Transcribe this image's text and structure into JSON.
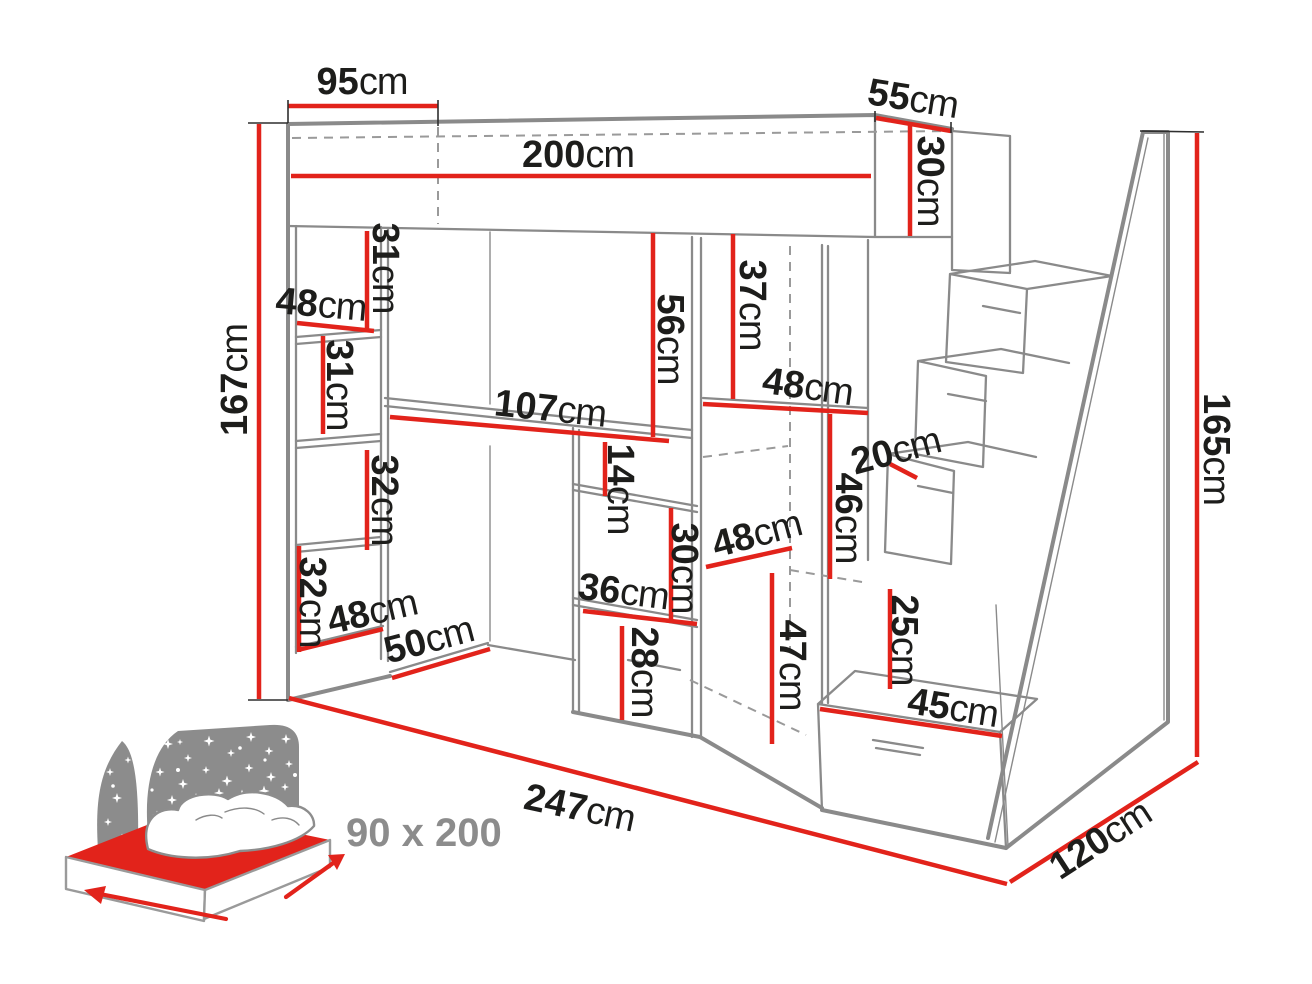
{
  "diagram": {
    "type": "furniture-dimension-drawing",
    "subject": "loft bed with desk, shelves and stair drawers",
    "colors": {
      "dimension_red": "#e2231b",
      "outline_gray": "#8a8a8a",
      "label_black": "#1d1d1b",
      "icon_gray": "#8c8c8c"
    },
    "footprint_icon": {
      "label": "90 x 200",
      "meaning": "mattress size icon"
    },
    "labels": [
      {
        "id": "95",
        "value": "95",
        "unit": "cm",
        "x": 362,
        "y": 94,
        "rot": 0
      },
      {
        "id": "200",
        "value": "200",
        "unit": "cm",
        "x": 578,
        "y": 167,
        "rot": 0
      },
      {
        "id": "55",
        "value": "55",
        "unit": "cm",
        "x": 911,
        "y": 111,
        "rot": 9
      },
      {
        "id": "30-bed",
        "value": "30",
        "unit": "cm",
        "x": 918,
        "y": 181,
        "rot": 90
      },
      {
        "id": "31-upper",
        "value": "31",
        "unit": "cm",
        "x": 373,
        "y": 268,
        "rot": 90
      },
      {
        "id": "48-shelf-top",
        "value": "48",
        "unit": "cm",
        "x": 320,
        "y": 317,
        "rot": 5
      },
      {
        "id": "31-lower",
        "value": "31",
        "unit": "cm",
        "x": 327,
        "y": 385,
        "rot": 90
      },
      {
        "id": "167",
        "value": "167",
        "unit": "cm",
        "x": 247,
        "y": 380,
        "rot": -90
      },
      {
        "id": "56",
        "value": "56",
        "unit": "cm",
        "x": 658,
        "y": 339,
        "rot": 90
      },
      {
        "id": "37",
        "value": "37",
        "unit": "cm",
        "x": 740,
        "y": 305,
        "rot": 90
      },
      {
        "id": "107",
        "value": "107",
        "unit": "cm",
        "x": 549,
        "y": 421,
        "rot": 6
      },
      {
        "id": "48-wardrobe-top",
        "value": "48",
        "unit": "cm",
        "x": 806,
        "y": 399,
        "rot": 8
      },
      {
        "id": "20",
        "value": "20",
        "unit": "cm",
        "x": 899,
        "y": 463,
        "rot": -15
      },
      {
        "id": "14",
        "value": "14",
        "unit": "cm",
        "x": 608,
        "y": 489,
        "rot": 90
      },
      {
        "id": "46",
        "value": "46",
        "unit": "cm",
        "x": 836,
        "y": 518,
        "rot": 90
      },
      {
        "id": "32-upper",
        "value": "32",
        "unit": "cm",
        "x": 372,
        "y": 500,
        "rot": 90
      },
      {
        "id": "30-cabinet",
        "value": "30",
        "unit": "cm",
        "x": 672,
        "y": 568,
        "rot": 90
      },
      {
        "id": "48-wardrobe-mid",
        "value": "48",
        "unit": "cm",
        "x": 760,
        "y": 546,
        "rot": -15
      },
      {
        "id": "32-lower",
        "value": "32",
        "unit": "cm",
        "x": 300,
        "y": 602,
        "rot": 90
      },
      {
        "id": "48-shelf-bottom",
        "value": "48",
        "unit": "cm",
        "x": 375,
        "y": 624,
        "rot": -13
      },
      {
        "id": "36",
        "value": "36",
        "unit": "cm",
        "x": 622,
        "y": 604,
        "rot": 7
      },
      {
        "id": "25",
        "value": "25",
        "unit": "cm",
        "x": 892,
        "y": 640,
        "rot": 90
      },
      {
        "id": "50",
        "value": "50",
        "unit": "cm",
        "x": 432,
        "y": 652,
        "rot": -15
      },
      {
        "id": "28",
        "value": "28",
        "unit": "cm",
        "x": 632,
        "y": 672,
        "rot": 90
      },
      {
        "id": "47",
        "value": "47",
        "unit": "cm",
        "x": 780,
        "y": 665,
        "rot": 90
      },
      {
        "id": "45",
        "value": "45",
        "unit": "cm",
        "x": 951,
        "y": 720,
        "rot": 9
      },
      {
        "id": "165",
        "value": "165",
        "unit": "cm",
        "x": 1204,
        "y": 449,
        "rot": 90
      },
      {
        "id": "247",
        "value": "247",
        "unit": "cm",
        "x": 577,
        "y": 820,
        "rot": 12
      },
      {
        "id": "120",
        "value": "120",
        "unit": "cm",
        "x": 1107,
        "y": 850,
        "rot": -33
      },
      {
        "id": "footprint",
        "value": "90 x 200",
        "unit": "",
        "x": 346,
        "y": 846,
        "rot": 0,
        "cls": "footprint"
      }
    ]
  }
}
